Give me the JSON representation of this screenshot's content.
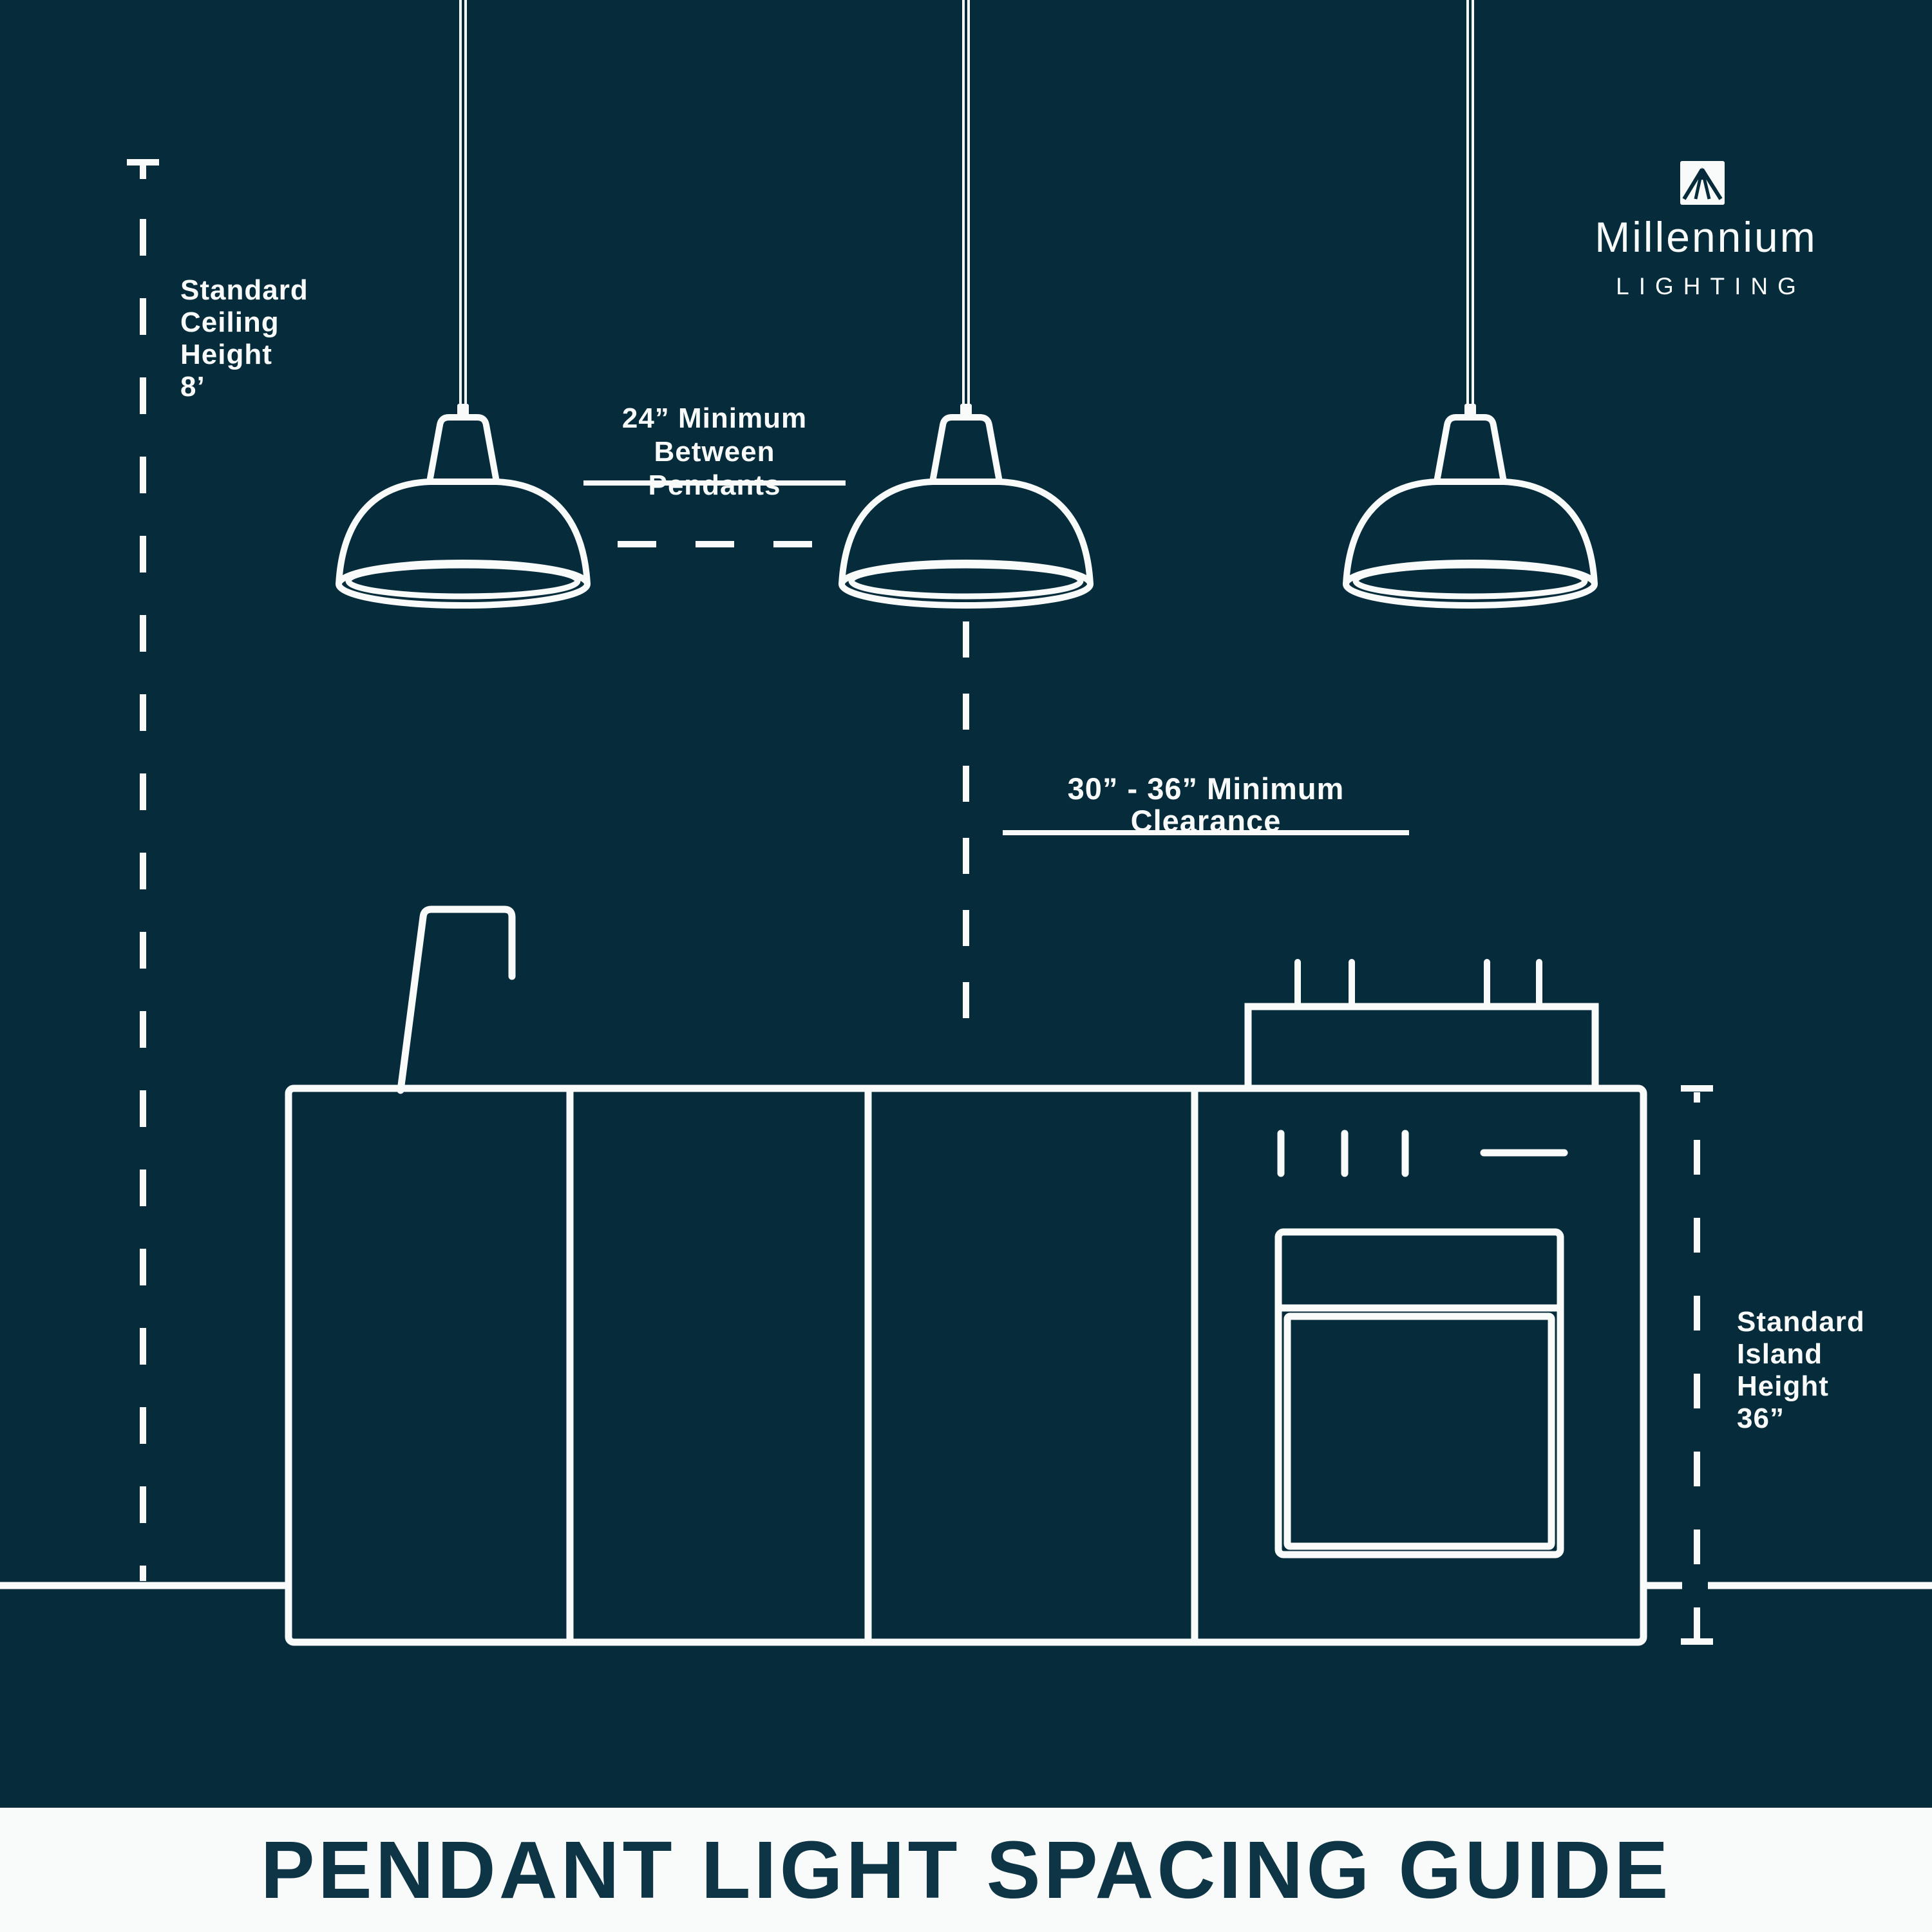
{
  "colors": {
    "background": "#062c3b",
    "line": "#f9fbfb",
    "banner_bg": "#f9fbfb",
    "banner_text": "#0d3545"
  },
  "logo": {
    "wordmark": "Millennium",
    "subtitle": "LIGHTING",
    "mark": "tent-beam-monogram-icon"
  },
  "annotations": {
    "ceiling_height": {
      "line1": "Standard",
      "line2": "Ceiling",
      "line3": "Height",
      "line4": "8’"
    },
    "pendant_spacing": {
      "line1": "24” Minimum",
      "line2": "Between Pendants"
    },
    "clearance": {
      "text": "30” - 36” Minimum Clearance"
    },
    "island_height": {
      "line1": "Standard",
      "line2": "Island",
      "line3": "Height",
      "line4": "36”"
    }
  },
  "banner": {
    "title": "PENDANT LIGHT SPACING GUIDE"
  }
}
